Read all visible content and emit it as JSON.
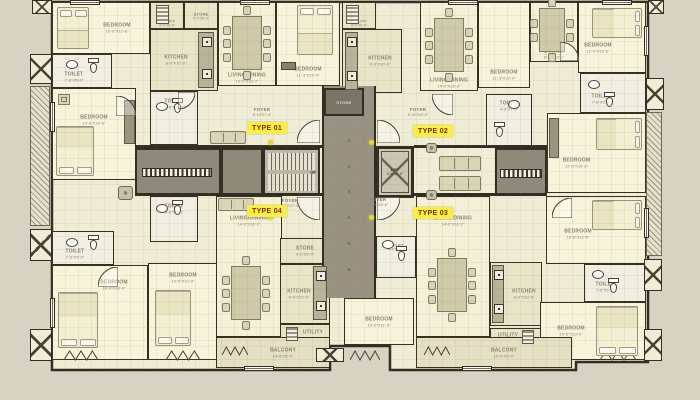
{
  "palette": {
    "background": "#d8d2c3",
    "building_fill": "#f0edd7",
    "wall": "#332c22",
    "core_gray": "#8f897a",
    "passage_gray": "#999283",
    "store_gray": "#7b7466",
    "highlight_yellow": "#f9ee43",
    "highlight_text": "#7c2d00",
    "label_text": "#8b8271",
    "dot_yellow": "#e4da3c",
    "room_fills": {
      "bedroom": "#f7f4dc",
      "toilet": "#f1eee2",
      "kitchen": "#e9e5c9",
      "utility": "#e9e5c9",
      "store": "#e9e5c9",
      "living": "#f4f1d8",
      "dining": "#f4f1d8",
      "balcony": "#e5e0c3"
    }
  },
  "core": {
    "passage_label": "PASSAGE",
    "lift_label": "LIFT",
    "lift_dims": "5'-6\"X6'-6\"",
    "stairs_up_label": "UP",
    "store_label": "STORE"
  },
  "type_labels": [
    {
      "id": "type-01",
      "text": "TYPE 01",
      "x": 247,
      "y": 122
    },
    {
      "id": "type-02",
      "text": "TYPE 02",
      "x": 413,
      "y": 125
    },
    {
      "id": "type-04",
      "text": "TYPE 04",
      "x": 247,
      "y": 205
    },
    {
      "id": "type-03",
      "text": "TYPE 03",
      "x": 413,
      "y": 207
    }
  ],
  "floor_labels": [
    {
      "text": "FOYER",
      "dims": "6'-10\"X7'-4\"",
      "x": 262,
      "y": 107
    },
    {
      "text": "FOYER",
      "dims": "6'-10\"X10'-8\"",
      "x": 418,
      "y": 107
    },
    {
      "text": "FOYER",
      "dims": "8'-10\"X7'-4\"",
      "x": 290,
      "y": 198
    },
    {
      "text": "FOYER",
      "dims": "8'-10\"X10'-8\"",
      "x": 378,
      "y": 197
    }
  ],
  "rooms": [
    {
      "id": "bedroom-1",
      "kind": "bedroom",
      "label": "BEDROOM",
      "dims": "10'-0\"X12'-6\"",
      "x": 52,
      "y": 2,
      "w": 98,
      "h": 52,
      "dx": 16,
      "dy": 0
    },
    {
      "id": "toilet-1",
      "kind": "toilet",
      "label": "TOILET",
      "dims": "7'-6\"X5'-0\"",
      "x": 52,
      "y": 54,
      "w": 60,
      "h": 34,
      "dx": -8,
      "dy": 6
    },
    {
      "id": "bedroom-2",
      "kind": "bedroom",
      "label": "BEDROOM",
      "dims": "10'-0\"X14'-6\"",
      "x": 52,
      "y": 88,
      "w": 84,
      "h": 92,
      "dx": 0,
      "dy": -14
    },
    {
      "id": "toilet-2",
      "kind": "toilet",
      "label": "TOILET",
      "dims": "7'-6\"X5'-0\"",
      "x": 52,
      "y": 231,
      "w": 62,
      "h": 34,
      "dx": -8,
      "dy": 6
    },
    {
      "id": "bedroom-3",
      "kind": "bedroom",
      "label": "BEDROOM",
      "dims": "10'-0\"X13'-0\"",
      "x": 52,
      "y": 265,
      "w": 96,
      "h": 95,
      "dx": 14,
      "dy": -28
    },
    {
      "id": "bedroom-4",
      "kind": "bedroom",
      "label": "BEDROOM",
      "dims": "10'-6\"X12'-0\"",
      "x": 148,
      "y": 263,
      "w": 70,
      "h": 97,
      "dx": 0,
      "dy": -34
    },
    {
      "id": "utility-1",
      "kind": "utility",
      "label": "UTILITY",
      "dims": "4'-0\"X6'-0\"",
      "x": 150,
      "y": 2,
      "w": 34,
      "h": 27,
      "dx": 0,
      "dy": 7
    },
    {
      "id": "store-1",
      "kind": "store",
      "label": "STORE",
      "dims": "4'-0\"X6'-0\"",
      "x": 184,
      "y": 2,
      "w": 34,
      "h": 27,
      "dx": 0,
      "dy": 0
    },
    {
      "id": "kitchen-1",
      "kind": "kitchen",
      "label": "KITCHEN",
      "dims": "8'-0\"X10'-6\"",
      "x": 150,
      "y": 29,
      "w": 68,
      "h": 62,
      "dx": -8,
      "dy": 0
    },
    {
      "id": "toilet-3",
      "kind": "toilet",
      "label": "TOILET",
      "dims": "4'-6\"X7'-0\"",
      "x": 150,
      "y": 91,
      "w": 48,
      "h": 54,
      "dx": 0,
      "dy": -14
    },
    {
      "id": "toilet-4",
      "kind": "toilet",
      "label": "TOILET",
      "dims": "4'-6\"X7'-0\"",
      "x": 150,
      "y": 196,
      "w": 48,
      "h": 46,
      "dx": 0,
      "dy": -10
    },
    {
      "id": "living-1",
      "kind": "living",
      "label": "LIVING/DINING",
      "dims": "14'-0\"X16'-2\"",
      "x": 218,
      "y": 2,
      "w": 58,
      "h": 84,
      "dx": 0,
      "dy": 34
    },
    {
      "id": "bedroom-5",
      "kind": "bedroom",
      "label": "BEDROOM",
      "dims": "11'-3\"X13'-9\"",
      "x": 276,
      "y": 2,
      "w": 64,
      "h": 84,
      "dx": 0,
      "dy": 28
    },
    {
      "id": "living-2",
      "kind": "living",
      "label": "LIVING/DINING",
      "dims": "14'-0\"X16'-2\"",
      "x": 216,
      "y": 196,
      "w": 66,
      "h": 141,
      "dx": 0,
      "dy": -46
    },
    {
      "id": "store-2",
      "kind": "store",
      "label": "STORE",
      "dims": "4'-0\"X5'-0\"",
      "x": 280,
      "y": 238,
      "w": 50,
      "h": 26,
      "dx": 0,
      "dy": 0
    },
    {
      "id": "kitchen-2",
      "kind": "kitchen",
      "label": "KITCHEN",
      "dims": "8'-0\"X10'-6\"",
      "x": 280,
      "y": 264,
      "w": 50,
      "h": 60,
      "dx": -6,
      "dy": 0
    },
    {
      "id": "utility-2",
      "kind": "utility",
      "label": "UTILITY",
      "dims": "4'-0\"X6'-0\"",
      "x": 280,
      "y": 324,
      "w": 50,
      "h": 21,
      "dx": 8,
      "dy": 0
    },
    {
      "id": "balcony-1",
      "kind": "balcony",
      "label": "BALCONY",
      "dims": "14'-6\"X5'-0\"",
      "x": 216,
      "y": 337,
      "w": 114,
      "h": 31,
      "dx": 10,
      "dy": 0
    },
    {
      "id": "utility-3",
      "kind": "utility",
      "label": "UTILITY",
      "dims": "4'-0\"X6'-0\"",
      "x": 342,
      "y": 2,
      "w": 34,
      "h": 27,
      "dx": 0,
      "dy": 7
    },
    {
      "id": "kitchen-3",
      "kind": "kitchen",
      "label": "KITCHEN",
      "dims": "8'-0\"X10'-6\"",
      "x": 342,
      "y": 29,
      "w": 60,
      "h": 64,
      "dx": 8,
      "dy": 0
    },
    {
      "id": "bedroom-10",
      "kind": "bedroom",
      "label": "BEDROOM",
      "dims": "10'-0\"X11'-6\"",
      "x": 344,
      "y": 298,
      "w": 70,
      "h": 47,
      "dx": 0,
      "dy": 0
    },
    {
      "id": "toilet-5",
      "kind": "toilet",
      "label": "TOILET",
      "dims": "4'-6\"X7'-0\"",
      "x": 376,
      "y": 236,
      "w": 40,
      "h": 42,
      "dx": 0,
      "dy": -10
    },
    {
      "id": "living-3",
      "kind": "living",
      "label": "LIVING/DINING",
      "dims": "14'-0\"X16'-2\"",
      "x": 420,
      "y": 2,
      "w": 58,
      "h": 89,
      "dx": 0,
      "dy": 36
    },
    {
      "id": "bedroom-6",
      "kind": "bedroom",
      "label": "BEDROOM",
      "dims": "11'-3\"X13'-9\"",
      "x": 478,
      "y": 2,
      "w": 52,
      "h": 86,
      "dx": 0,
      "dy": 30
    },
    {
      "id": "dining-2",
      "kind": "dining",
      "label": "DINING",
      "dims": "8'-0\"X10'-0\"",
      "x": 530,
      "y": 2,
      "w": 48,
      "h": 60,
      "dx": 0,
      "dy": 22
    },
    {
      "id": "bedroom-7",
      "kind": "bedroom",
      "label": "BEDROOM",
      "dims": "12'-0\"X13'-6\"",
      "x": 578,
      "y": 2,
      "w": 68,
      "h": 71,
      "dx": -14,
      "dy": 10
    },
    {
      "id": "toilet-7",
      "kind": "toilet",
      "label": "TOILET",
      "dims": "7'-6\"X5'-0\"",
      "x": 580,
      "y": 73,
      "w": 66,
      "h": 40,
      "dx": -12,
      "dy": 6
    },
    {
      "id": "toilet-6",
      "kind": "toilet",
      "label": "TOILET",
      "dims": "4'-6\"X7'-0\"",
      "x": 486,
      "y": 94,
      "w": 46,
      "h": 52,
      "dx": 0,
      "dy": -14
    },
    {
      "id": "bedroom-8",
      "kind": "bedroom",
      "label": "BEDROOM",
      "dims": "12'-0\"X10'-6\"",
      "x": 547,
      "y": 113,
      "w": 99,
      "h": 80,
      "dx": -20,
      "dy": 10
    },
    {
      "id": "living-4",
      "kind": "living",
      "label": "LIVING/DINING",
      "dims": "14'-0\"X16'-2\"",
      "x": 416,
      "y": 196,
      "w": 74,
      "h": 141,
      "dx": 0,
      "dy": -46
    },
    {
      "id": "kitchen-4",
      "kind": "kitchen",
      "label": "KITCHEN",
      "dims": "8'-0\"X10'-6\"",
      "x": 490,
      "y": 262,
      "w": 52,
      "h": 64,
      "dx": 8,
      "dy": 0
    },
    {
      "id": "utility-4",
      "kind": "utility",
      "label": "UTILITY",
      "dims": "4'-0\"X6'-0\"",
      "x": 490,
      "y": 328,
      "w": 52,
      "h": 19,
      "dx": -8,
      "dy": 0
    },
    {
      "id": "bedroom-9",
      "kind": "bedroom",
      "label": "BEDROOM",
      "dims": "10'-6\"X12'-0\"",
      "x": 546,
      "y": 196,
      "w": 100,
      "h": 68,
      "dx": -18,
      "dy": 4
    },
    {
      "id": "toilet-8",
      "kind": "toilet",
      "label": "TOILET",
      "dims": "7'-6\"X5'-0\"",
      "x": 584,
      "y": 264,
      "w": 62,
      "h": 38,
      "dx": -10,
      "dy": 4
    },
    {
      "id": "bedroom-11",
      "kind": "bedroom",
      "label": "BEDROOM",
      "dims": "10'-0\"X13'-0\"",
      "x": 540,
      "y": 302,
      "w": 106,
      "h": 58,
      "dx": -22,
      "dy": 0
    },
    {
      "id": "balcony-2",
      "kind": "balcony",
      "label": "BALCONY",
      "dims": "14'-6\"X5'-0\"",
      "x": 416,
      "y": 337,
      "w": 156,
      "h": 31,
      "dx": 10,
      "dy": 0
    }
  ],
  "furniture": [
    {
      "kind": "bed",
      "x": 57,
      "y": 7,
      "w": 32,
      "h": 42,
      "side": "top"
    },
    {
      "kind": "bed",
      "x": 56,
      "y": 126,
      "w": 38,
      "h": 50,
      "side": "bottom"
    },
    {
      "kind": "bed",
      "x": 58,
      "y": 292,
      "w": 40,
      "h": 56,
      "side": "bottom"
    },
    {
      "kind": "bed",
      "x": 155,
      "y": 290,
      "w": 36,
      "h": 56,
      "side": "bottom"
    },
    {
      "kind": "bed",
      "x": 297,
      "y": 5,
      "w": 36,
      "h": 50,
      "side": "top"
    },
    {
      "kind": "bed",
      "x": 592,
      "y": 8,
      "w": 50,
      "h": 30,
      "side": "right"
    },
    {
      "kind": "bed",
      "x": 596,
      "y": 118,
      "w": 46,
      "h": 32,
      "side": "right"
    },
    {
      "kind": "bed",
      "x": 592,
      "y": 200,
      "w": 50,
      "h": 30,
      "side": "right"
    },
    {
      "kind": "bed",
      "x": 596,
      "y": 306,
      "w": 42,
      "h": 50,
      "side": "bottom"
    },
    {
      "kind": "table",
      "x": 232,
      "y": 16,
      "w": 30,
      "h": 54,
      "seats": 8
    },
    {
      "kind": "table",
      "x": 434,
      "y": 18,
      "w": 30,
      "h": 54,
      "seats": 8
    },
    {
      "kind": "table",
      "x": 231,
      "y": 266,
      "w": 30,
      "h": 54,
      "seats": 8
    },
    {
      "kind": "table",
      "x": 437,
      "y": 258,
      "w": 30,
      "h": 54,
      "seats": 8
    },
    {
      "kind": "table",
      "x": 539,
      "y": 8,
      "w": 26,
      "h": 44,
      "seats": 6
    },
    {
      "kind": "sofa",
      "x": 210,
      "y": 131,
      "w": 36,
      "h": 13
    },
    {
      "kind": "sofa",
      "x": 218,
      "y": 198,
      "w": 36,
      "h": 13
    },
    {
      "kind": "sofa",
      "x": 439,
      "y": 156,
      "w": 42,
      "h": 15
    },
    {
      "kind": "sofa",
      "x": 439,
      "y": 176,
      "w": 42,
      "h": 15
    },
    {
      "kind": "wc",
      "x": 88,
      "y": 58
    },
    {
      "kind": "basin",
      "x": 66,
      "y": 60
    },
    {
      "kind": "wc",
      "x": 88,
      "y": 235
    },
    {
      "kind": "basin",
      "x": 66,
      "y": 238
    },
    {
      "kind": "wc",
      "x": 172,
      "y": 98
    },
    {
      "kind": "basin",
      "x": 156,
      "y": 102
    },
    {
      "kind": "wc",
      "x": 172,
      "y": 200
    },
    {
      "kind": "basin",
      "x": 156,
      "y": 204
    },
    {
      "kind": "wc",
      "x": 396,
      "y": 246
    },
    {
      "kind": "basin",
      "x": 382,
      "y": 240
    },
    {
      "kind": "wc",
      "x": 494,
      "y": 122
    },
    {
      "kind": "basin",
      "x": 508,
      "y": 100
    },
    {
      "kind": "wc",
      "x": 604,
      "y": 92
    },
    {
      "kind": "basin",
      "x": 588,
      "y": 80
    },
    {
      "kind": "wc",
      "x": 608,
      "y": 278
    },
    {
      "kind": "basin",
      "x": 592,
      "y": 270
    },
    {
      "kind": "counter",
      "x": 198,
      "y": 32,
      "w": 16,
      "h": 56,
      "appl": 2
    },
    {
      "kind": "counter",
      "x": 345,
      "y": 32,
      "w": 13,
      "h": 58,
      "appl": 2
    },
    {
      "kind": "counter",
      "x": 313,
      "y": 266,
      "w": 14,
      "h": 54,
      "appl": 2
    },
    {
      "kind": "counter",
      "x": 492,
      "y": 265,
      "w": 12,
      "h": 58,
      "appl": 2
    },
    {
      "kind": "fridge",
      "x": 156,
      "y": 5,
      "w": 13,
      "h": 19
    },
    {
      "kind": "fridge",
      "x": 346,
      "y": 5,
      "w": 13,
      "h": 19
    },
    {
      "kind": "fridge",
      "x": 286,
      "y": 327,
      "w": 12,
      "h": 14
    },
    {
      "kind": "fridge",
      "x": 522,
      "y": 330,
      "w": 12,
      "h": 14
    },
    {
      "kind": "wardrobe",
      "x": 124,
      "y": 100,
      "w": 11,
      "h": 44
    },
    {
      "kind": "wardrobe",
      "x": 549,
      "y": 118,
      "w": 10,
      "h": 40
    },
    {
      "kind": "chairsq",
      "x": 58,
      "y": 94,
      "w": 12,
      "h": 11
    },
    {
      "kind": "planter",
      "x": 118,
      "y": 186,
      "w": 15,
      "h": 14
    },
    {
      "kind": "planter",
      "x": 426,
      "y": 143,
      "w": 11,
      "h": 10
    },
    {
      "kind": "planter",
      "x": 426,
      "y": 190,
      "w": 11,
      "h": 10
    },
    {
      "kind": "dresser",
      "x": 281,
      "y": 62,
      "w": 15,
      "h": 8
    }
  ],
  "core_boxes": {
    "foyer_left": {
      "x": 135,
      "y": 148,
      "w": 86,
      "h": 48
    },
    "gray_left2": {
      "x": 221,
      "y": 148,
      "w": 42,
      "h": 48
    },
    "stairs": {
      "x": 263,
      "y": 148,
      "w": 57,
      "h": 48
    },
    "passage": {
      "x": 322,
      "y": 86,
      "w": 54,
      "h": 212
    },
    "store_dark": {
      "x": 324,
      "y": 88,
      "w": 40,
      "h": 28
    },
    "lift": {
      "x": 376,
      "y": 146,
      "w": 38,
      "h": 52
    },
    "foyer_right": {
      "x": 495,
      "y": 148,
      "w": 52,
      "h": 48
    },
    "mats": [
      {
        "x": 142,
        "y": 168,
        "w": 70,
        "h": 9
      },
      {
        "x": 500,
        "y": 169,
        "w": 42,
        "h": 9
      }
    ]
  },
  "walls": [
    {
      "x": 135,
      "y": 145,
      "w": 187,
      "h": 3
    },
    {
      "x": 135,
      "y": 193,
      "w": 187,
      "h": 3
    },
    {
      "x": 414,
      "y": 145,
      "w": 133,
      "h": 3
    },
    {
      "x": 414,
      "y": 193,
      "w": 133,
      "h": 3
    }
  ],
  "dots": [
    {
      "x": 268,
      "y": 140
    },
    {
      "x": 369,
      "y": 140
    },
    {
      "x": 268,
      "y": 215
    },
    {
      "x": 369,
      "y": 215
    }
  ],
  "ducts": [
    {
      "x": 32,
      "y": 0,
      "w": 20,
      "h": 14
    },
    {
      "x": 30,
      "y": 54,
      "w": 22,
      "h": 30
    },
    {
      "x": 30,
      "y": 229,
      "w": 22,
      "h": 32
    },
    {
      "x": 30,
      "y": 329,
      "w": 22,
      "h": 32
    },
    {
      "x": 648,
      "y": 0,
      "w": 16,
      "h": 14
    },
    {
      "x": 646,
      "y": 78,
      "w": 18,
      "h": 32
    },
    {
      "x": 644,
      "y": 259,
      "w": 18,
      "h": 32
    },
    {
      "x": 644,
      "y": 329,
      "w": 18,
      "h": 32
    },
    {
      "x": 316,
      "y": 348,
      "w": 28,
      "h": 14
    }
  ],
  "ledges": [
    {
      "x": 30,
      "y": 86,
      "w": 20,
      "h": 140
    },
    {
      "x": 646,
      "y": 112,
      "w": 16,
      "h": 144
    }
  ],
  "windows": [
    {
      "x": 70,
      "y": 0,
      "w": 30,
      "h": 4.5
    },
    {
      "x": 240,
      "y": 0,
      "w": 30,
      "h": 4.5
    },
    {
      "x": 448,
      "y": 0,
      "w": 30,
      "h": 4.5
    },
    {
      "x": 602,
      "y": 0,
      "w": 30,
      "h": 4.5
    },
    {
      "x": 50,
      "y": 102,
      "w": 4.5,
      "h": 30
    },
    {
      "x": 50,
      "y": 298,
      "w": 4.5,
      "h": 30
    },
    {
      "x": 644,
      "y": 26,
      "w": 4.5,
      "h": 30
    },
    {
      "x": 644,
      "y": 208,
      "w": 4.5,
      "h": 30
    },
    {
      "x": 244,
      "y": 366,
      "w": 30,
      "h": 4.5
    },
    {
      "x": 462,
      "y": 366,
      "w": 30,
      "h": 4.5
    }
  ],
  "zigzags": [
    {
      "x": 64,
      "y": 348,
      "w": 34,
      "h": 11
    },
    {
      "x": 166,
      "y": 348,
      "w": 34,
      "h": 11
    },
    {
      "x": 350,
      "y": 348,
      "w": 30,
      "h": 11
    },
    {
      "x": 600,
      "y": 348,
      "w": 36,
      "h": 11
    },
    {
      "x": 222,
      "y": 343,
      "w": 26,
      "h": 10
    },
    {
      "x": 424,
      "y": 343,
      "w": 26,
      "h": 10
    }
  ],
  "arcs": [
    {
      "x": 297,
      "y": 120,
      "r": 23,
      "rot": 0
    },
    {
      "x": 377,
      "y": 120,
      "r": 23,
      "rot": 90
    },
    {
      "x": 297,
      "y": 197,
      "r": 23,
      "rot": 270
    },
    {
      "x": 377,
      "y": 197,
      "r": 23,
      "rot": 180
    },
    {
      "x": 116,
      "y": 96,
      "r": 20,
      "rot": 90
    },
    {
      "x": 98,
      "y": 267,
      "r": 20,
      "rot": 0
    },
    {
      "x": 432,
      "y": 94,
      "r": 21,
      "rot": 270
    },
    {
      "x": 552,
      "y": 198,
      "r": 20,
      "rot": 0
    },
    {
      "x": 178,
      "y": 92,
      "r": 17,
      "rot": 180
    },
    {
      "x": 560,
      "y": 42,
      "r": 19,
      "rot": 90
    }
  ]
}
